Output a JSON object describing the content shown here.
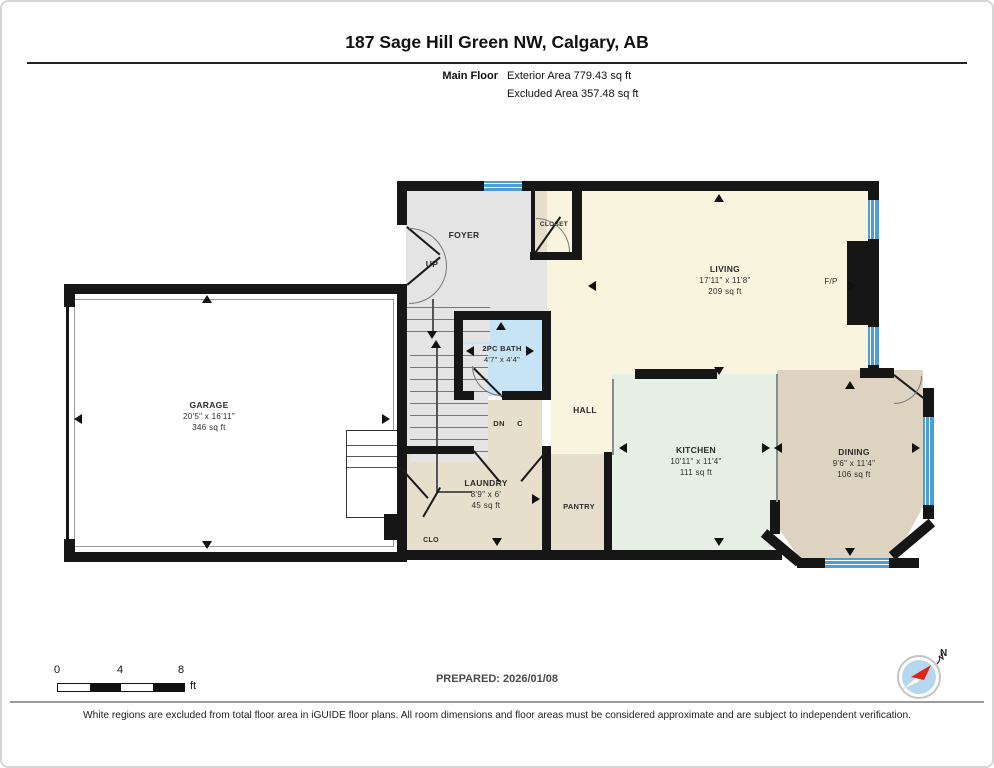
{
  "page": {
    "title": "187 Sage Hill Green NW, Calgary, AB",
    "floor_label": "Main Floor",
    "exterior_area": "Exterior Area 779.43 sq ft",
    "excluded_area": "Excluded Area 357.48 sq ft"
  },
  "rooms": {
    "foyer": {
      "name": "FOYER"
    },
    "closet": {
      "name": "CLOSET"
    },
    "living": {
      "name": "LIVING",
      "dims": "17'11\" x 11'8\"",
      "area": "209 sq ft"
    },
    "garage": {
      "name": "GARAGE",
      "dims": "20'5\" x 16'11\"",
      "area": "346 sq ft"
    },
    "bath": {
      "name": "2PC BATH",
      "dims": "4'7\" x 4'4\""
    },
    "hall": {
      "name": "HALL"
    },
    "kitchen": {
      "name": "KITCHEN",
      "dims": "10'11\" x 11'4\"",
      "area": "111 sq ft"
    },
    "dining": {
      "name": "DINING",
      "dims": "9'6\" x 11'4\"",
      "area": "106 sq ft"
    },
    "laundry": {
      "name": "LAUNDRY",
      "dims": "8'9\" x 6'",
      "area": "45 sq ft"
    },
    "pantry": {
      "name": "PANTRY"
    },
    "clo": {
      "name": "CLO"
    }
  },
  "plan_labels": {
    "up": "UP",
    "dn": "DN",
    "c": "C",
    "fireplace": "F/P"
  },
  "footer": {
    "prepared": "PREPARED: 2026/01/08",
    "disclaimer": "White regions are excluded from total floor area in iGUIDE floor plans. All room dimensions and floor areas must be considered approximate and are subject to independent verification.",
    "scale_ticks": [
      "0",
      "4",
      "8"
    ],
    "scale_unit": "ft",
    "compass_n": "N"
  },
  "colors": {
    "wall": "#161616",
    "foyer_gray": "#e4e4e4",
    "living_cream": "#f9f4de",
    "kitchen_mint": "#e6efe4",
    "beige": "#e7decb",
    "dining_tan": "#ddd3c0",
    "bath_blue": "#c6e4f6",
    "window_blue": "#4d9ed3",
    "garage_white": "#ffffff",
    "compass_red": "#e32119",
    "compass_blue": "#b5d8ee"
  }
}
